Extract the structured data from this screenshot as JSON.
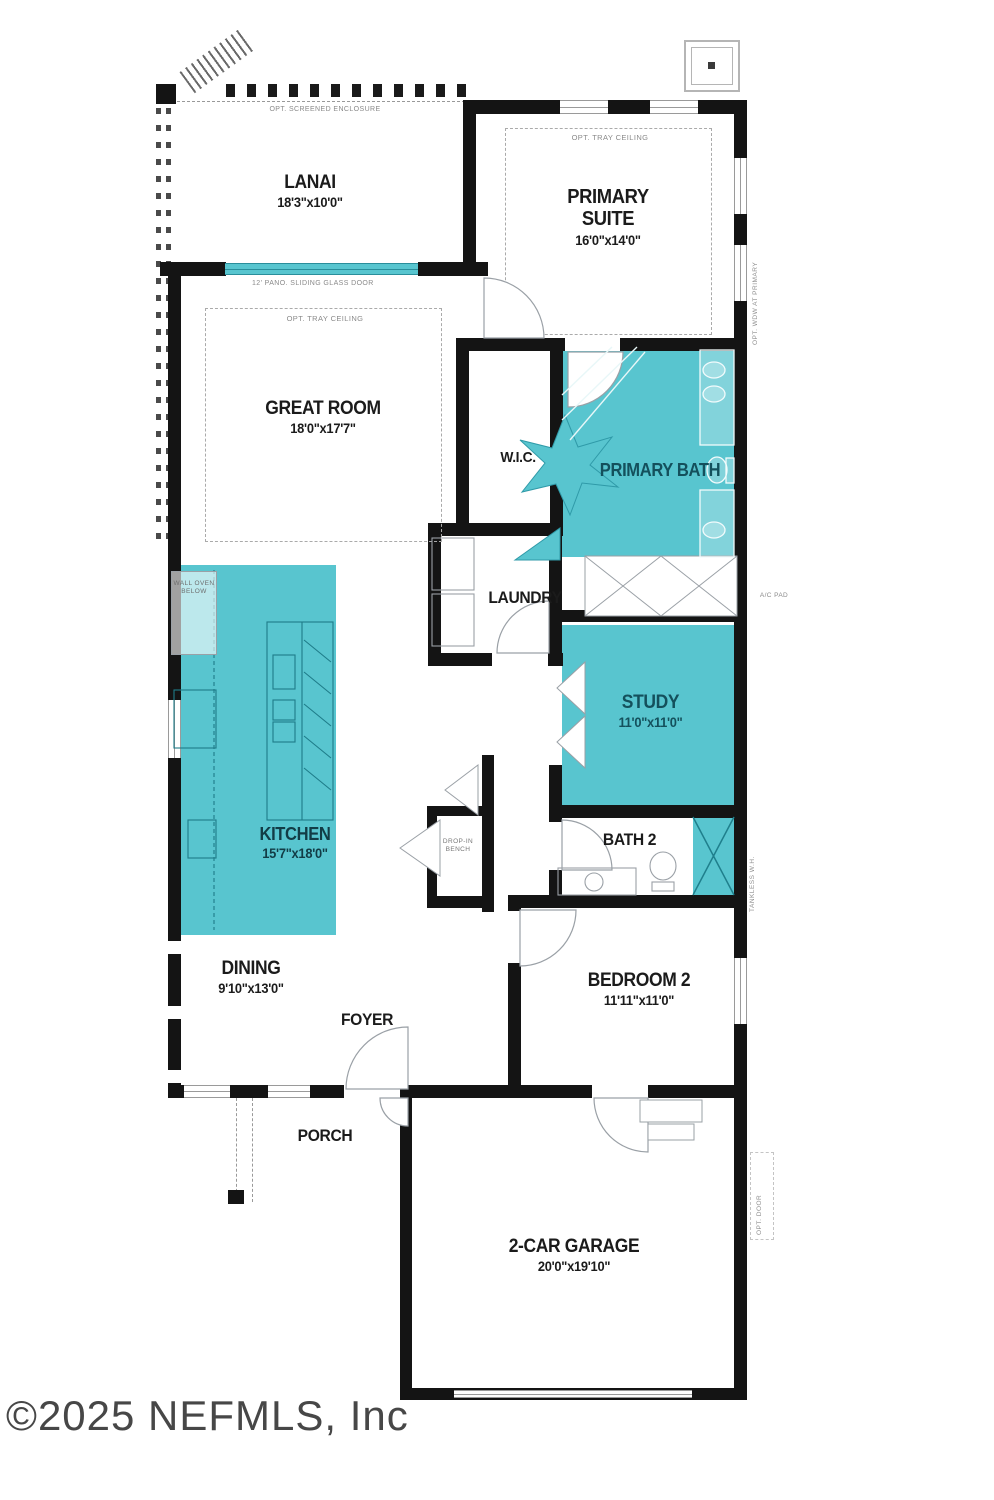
{
  "watermark": "©2025 NEFMLS, Inc",
  "colors": {
    "room_fill": "#58c5cf",
    "wall": "#141414",
    "teal_label": "#14505c"
  },
  "rooms": [
    {
      "id": "lanai",
      "name": "LANAI",
      "dims": "18'3\"x10'0\""
    },
    {
      "id": "primary-suite",
      "name": "PRIMARY SUITE",
      "dims": "16'0\"x14'0\""
    },
    {
      "id": "great-room",
      "name": "GREAT ROOM",
      "dims": "18'0\"x17'7\""
    },
    {
      "id": "wic",
      "name": "W.I.C.",
      "dims": ""
    },
    {
      "id": "primary-bath",
      "name": "PRIMARY BATH",
      "dims": ""
    },
    {
      "id": "laundry",
      "name": "LAUNDRY",
      "dims": ""
    },
    {
      "id": "study",
      "name": "STUDY",
      "dims": "11'0\"x11'0\""
    },
    {
      "id": "kitchen",
      "name": "KITCHEN",
      "dims": "15'7\"x18'0\""
    },
    {
      "id": "bath-2",
      "name": "BATH 2",
      "dims": ""
    },
    {
      "id": "bedroom-2",
      "name": "BEDROOM 2",
      "dims": "11'11\"x11'0\""
    },
    {
      "id": "dining",
      "name": "DINING",
      "dims": "9'10\"x13'0\""
    },
    {
      "id": "foyer",
      "name": "FOYER",
      "dims": ""
    },
    {
      "id": "porch",
      "name": "PORCH",
      "dims": ""
    },
    {
      "id": "garage",
      "name": "2-CAR GARAGE",
      "dims": "20'0\"x19'10\""
    }
  ],
  "annotations": {
    "screened_enclosure": "OPT. SCREENED ENCLOSURE",
    "pano_door": "12' PANO. SLIDING GLASS DOOR",
    "tray_primary": "OPT. TRAY CEILING",
    "tray_great": "OPT. TRAY CEILING",
    "wall_oven": "WALL OVEN BELOW",
    "drop_bench": "DROP-IN BENCH",
    "opt_wdw": "OPT. WDW AT PRIMARY",
    "ac_pad": "A/C PAD",
    "tankless": "TANKLESS W.H.",
    "opt_door": "OPT. DOOR"
  }
}
